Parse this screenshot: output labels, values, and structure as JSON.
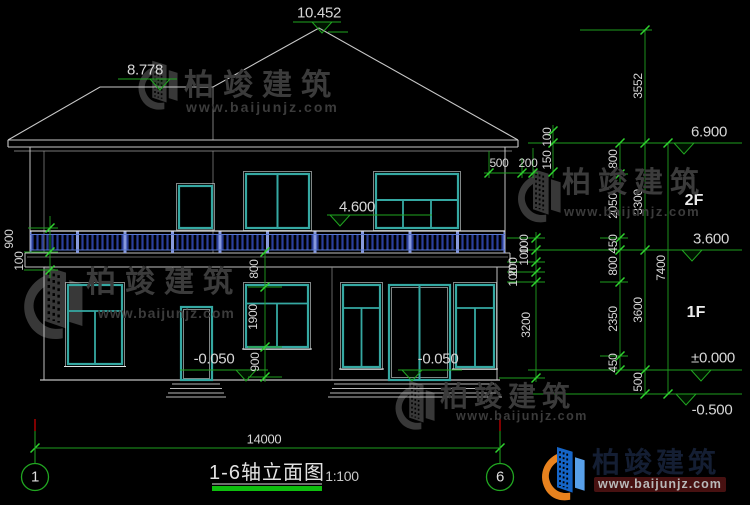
{
  "drawing": {
    "title": "1-6轴立面图",
    "scale": "1:100",
    "axis_left": "1",
    "axis_right": "6",
    "overall_width": "14000"
  },
  "elevation_marks": {
    "roof_peak": "10.452",
    "left_roof_ridge": "8.778",
    "eave": "6.900",
    "balcony_rail": "4.600",
    "second_floor": "3.600",
    "ground_zero": "±0.000",
    "site_ground": "-0.500",
    "entry_left": "-0.050",
    "entry_right": "-0.050"
  },
  "floor_labels": {
    "second": "2F",
    "first": "1F"
  },
  "dim_chains": {
    "right_detail": [
      "800",
      "2050",
      "450",
      "800",
      "2350",
      "450"
    ],
    "right_floors": [
      "3552",
      "3300",
      "3600",
      "500"
    ],
    "right_total": "7400",
    "left_balcony": [
      "900",
      "100"
    ],
    "middle_window": [
      "800",
      "1900",
      "900"
    ],
    "right_wall_detail": [
      "100",
      "100",
      "200",
      "100",
      "3200"
    ],
    "eave_vertical": [
      "100",
      "150"
    ],
    "eave_horizontal": [
      "500",
      "200"
    ]
  },
  "watermark": {
    "brand": "柏竣建筑",
    "website": "www.baijunjz.com"
  },
  "colors": {
    "dimension_green": "#21a621",
    "tick_green": "#2fd32f",
    "axis_red": "#d40000",
    "window_teal": "#35a8a2",
    "railing_navy": "#2a3f9b",
    "railing_post_blue": "#8799dc",
    "line_gray": "#c8c8c8",
    "underline_green": "#0ebe0e"
  }
}
